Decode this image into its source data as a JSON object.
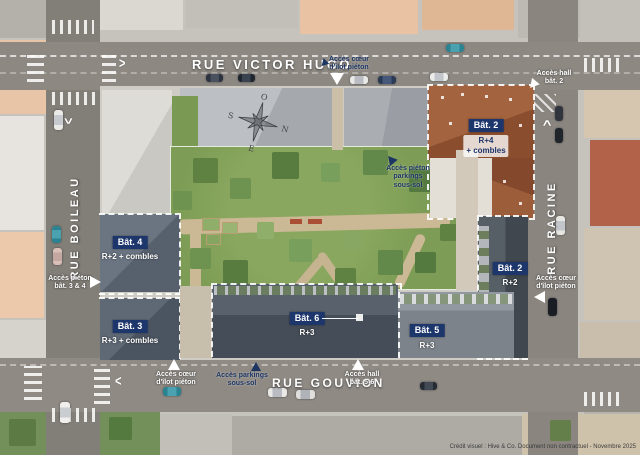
{
  "streets": {
    "top": "RUE VICTOR HUGO",
    "left": "RUE BOILEAU",
    "right": "RUE RACINE",
    "bottom": "RUE GOUVION"
  },
  "buildings": {
    "bat2_north": {
      "label": "Bât. 2",
      "floors": [
        "R+4",
        "+ combles"
      ]
    },
    "bat2_east": {
      "label": "Bât. 2",
      "floors": [
        "R+2"
      ]
    },
    "bat3": {
      "label": "Bât. 3",
      "floors": [
        "R+3 + combles"
      ]
    },
    "bat4": {
      "label": "Bât. 4",
      "floors": [
        "R+2 + combles"
      ]
    },
    "bat5": {
      "label": "Bât. 5",
      "floors": [
        "R+3"
      ]
    },
    "bat6": {
      "label": "Bât. 6",
      "floors": [
        "R+3"
      ]
    }
  },
  "access": {
    "top_pedestrian": {
      "lines": [
        "Accès cœur",
        "d'îlot piéton"
      ]
    },
    "top_right_hall": {
      "lines": [
        "Accès hall",
        "bât. 2"
      ]
    },
    "right_pedestrian": {
      "lines": [
        "Accès cœur",
        "d'îlot piéton"
      ]
    },
    "left_pedestrian": {
      "lines": [
        "Accès piéton",
        "bât. 3 & 4"
      ]
    },
    "bottom_left_pedestrian": {
      "lines": [
        "Accès cœur",
        "d'îlot piéton"
      ]
    },
    "bottom_parking": {
      "lines": [
        "Accès parkings",
        "sous-sol"
      ]
    },
    "bottom_hall": {
      "lines": [
        "Accès hall",
        "bât. 5-6"
      ]
    },
    "garden_parking": {
      "lines": [
        "Accès piéton",
        "parkings",
        "sous-sol"
      ]
    }
  },
  "compass": {
    "north": "N",
    "south": "S",
    "east": "E",
    "west": "O"
  },
  "caption": "Crédit visuel : Hive & Co. Document non contractuel - Novembre 2025",
  "colors": {
    "label_navy": "#1d366b",
    "road": "#8d8882",
    "garden_green": "#7d9c55",
    "roof_brown": "#96593c",
    "roof_slate": "#5b6572"
  }
}
